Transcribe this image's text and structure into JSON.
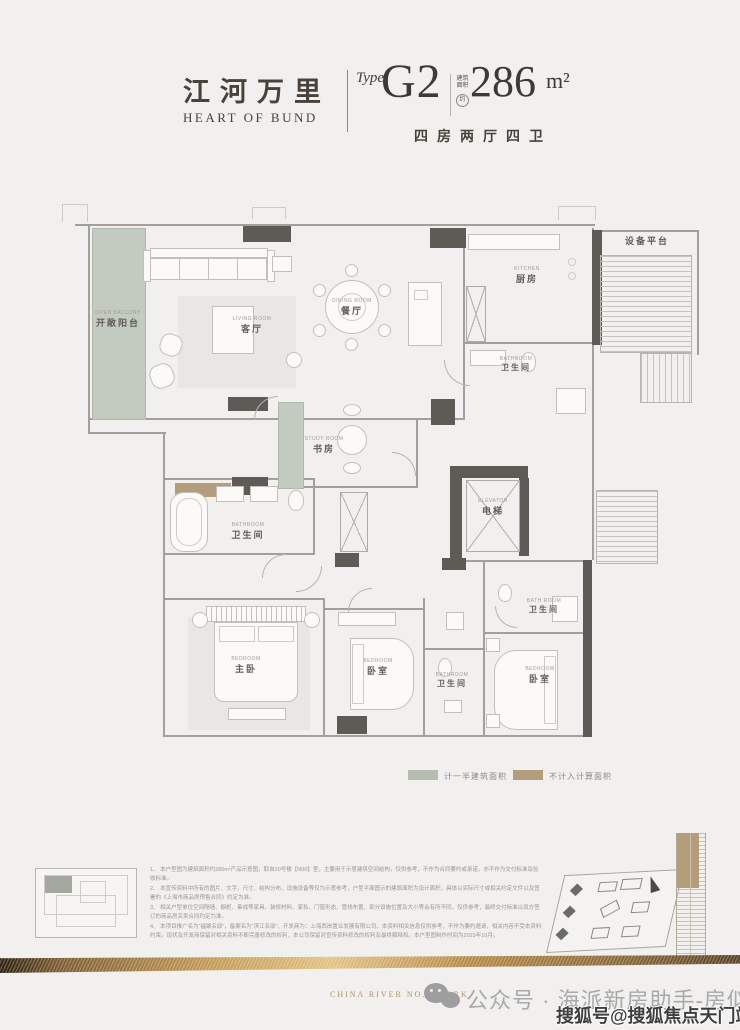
{
  "header": {
    "brand_cn": "江河万里",
    "brand_en": "HEART OF BUND",
    "type_label": "Type",
    "type_value": "G2",
    "area_prefix": "建筑面积",
    "area_circle": "约",
    "area_value": "286",
    "area_unit": "m²",
    "layout_desc": "四房两厅四卫"
  },
  "floorplan": {
    "rooms": {
      "balcony": {
        "en": "OPEN BALCONY",
        "cn": "开敞阳台"
      },
      "living": {
        "en": "LIVING ROOM",
        "cn": "客厅"
      },
      "dining": {
        "en": "DINING ROOM",
        "cn": "餐厅"
      },
      "kitchen": {
        "en": "KITCHEN",
        "cn": "厨房"
      },
      "bath_kitchen": {
        "en": "BATHROOM",
        "cn": "卫生间"
      },
      "equipment": {
        "cn": "设备平台"
      },
      "study": {
        "en": "STUDY ROOM",
        "cn": "书房"
      },
      "elevator": {
        "en": "ELEVATOR",
        "cn": "电梯"
      },
      "master_bath": {
        "en": "BATHROOM",
        "cn": "卫生间"
      },
      "master_bed": {
        "en": "BEDROOM",
        "cn": "主卧"
      },
      "bed2": {
        "en": "BEDROOM",
        "cn": "卧室"
      },
      "bath_mid": {
        "en": "BATHROOM",
        "cn": "卫生间"
      },
      "bath_right": {
        "en": "BATH ROOM",
        "cn": "卫生间"
      },
      "bed3": {
        "en": "BEDROOM",
        "cn": "卧室"
      }
    },
    "legend": {
      "half": {
        "label": "计一半建筑面积",
        "color": "#b5bdb0"
      },
      "excluded": {
        "label": "不计入计算面积",
        "color": "#b49d7c"
      }
    },
    "colors": {
      "wall_dark": "#5e5b57",
      "balcony_green": "#c3cabf",
      "excluded_tan": "#b49d7c",
      "accent_gold": "#c39a55"
    }
  },
  "notes": {
    "items": [
      "1、 本户型图为建筑面积约286m²产品示意图，取自20号楼【N00】室，主要用于示意建筑空间结构，仅供参考，不作为合同要约或承诺，亦不作为交付标准及验收标准。",
      "2、 本宣传资料中所有的图片、文字、尺寸、结构分布、设施设备等仅为示意参考，户型平面图示的建筑面积为设计面积，具体以实际尺寸或相关约定文件以及签署的《上海市商品房预售合同》约定为准。",
      "3、 相关户型单位空间隔墙、橱柜、集成等家具、装修材料、家私、门窗形态、管线布置、部分设施位置及大小等会有所不同，仅供参考，最终交付标准以双方签订的商品房买卖合同约定为准。",
      "4、 本项目推广名为“福聚名邸”，备案名为“滨江名邸”，开发商为：上海西岸置业发展有限公司。本资料相关信息仅供参考，不作为要约邀请，相关内容不受本资料约束。现状及开发商保留对相关资料不断完善修改的权利，本公司保留对宣传资料修改的权利及最终解释权。本户型图制作时间为2023年10月。"
    ]
  },
  "footer": {
    "brand_line": "CHINA RIVER NO.1 WORK",
    "wechat_watermark": "公众号 · 海派新房助手-房似锦",
    "sohu_watermark": "搜狐号@搜狐焦点天门站"
  }
}
